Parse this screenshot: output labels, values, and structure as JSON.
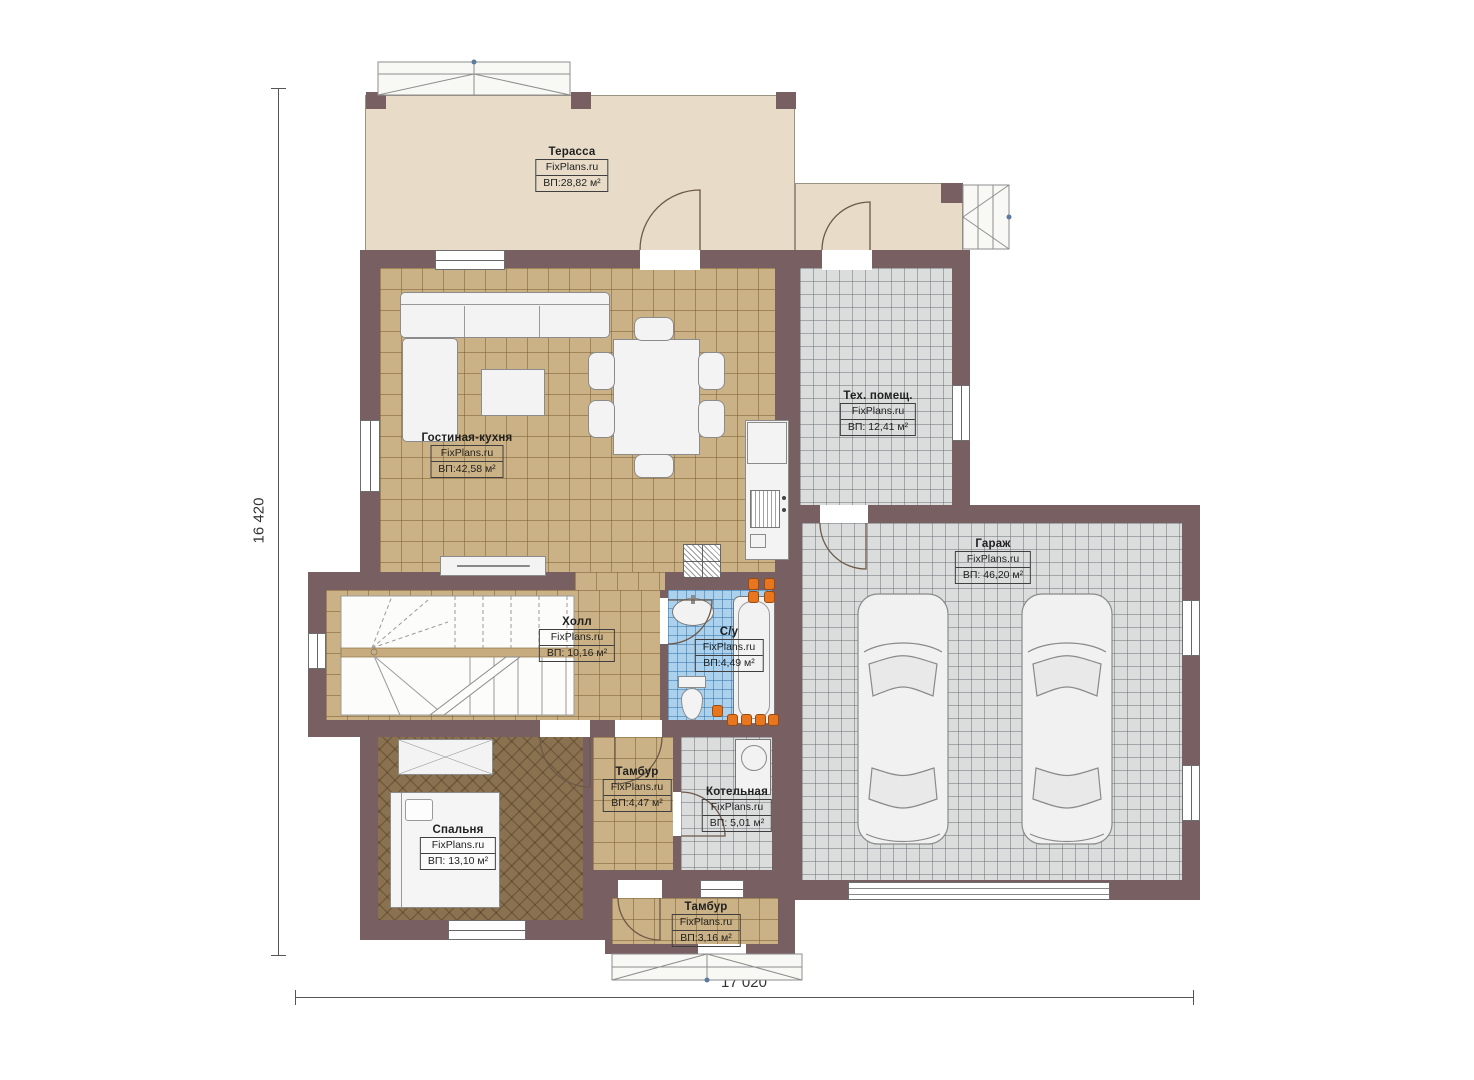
{
  "brand": "FixPlans.ru",
  "rooms": [
    {
      "name": "Терасса",
      "area": "ВП:28,82 м²"
    },
    {
      "name": "Гостиная-кухня",
      "area": "ВП:42,58 м²"
    },
    {
      "name": "Тех. помещ.",
      "area": "ВП: 12,41 м²"
    },
    {
      "name": "Гараж",
      "area": "ВП: 46,20 м²"
    },
    {
      "name": "Холл",
      "area": "ВП: 10,16 м²"
    },
    {
      "name": "С/у",
      "area": "ВП:4,49 м²"
    },
    {
      "name": "Тамбур",
      "area": "ВП:4,47 м²"
    },
    {
      "name": "Котельная",
      "area": "ВП: 5,01 м²"
    },
    {
      "name": "Спальня",
      "area": "ВП: 13,10 м²"
    },
    {
      "name": "Тамбур",
      "area": "ВП:3,16 м²"
    }
  ],
  "dimensions": {
    "height": "16 420",
    "width": "17 020"
  },
  "colors": {
    "wall": "#775f62",
    "terrace_floor": "#e8dcc8",
    "tile_tan": "#cbb286",
    "tile_gray": "#dbdcdc",
    "tile_blue": "#abd1ed",
    "parquet": "#8a7150",
    "heating": "#e8761f"
  }
}
